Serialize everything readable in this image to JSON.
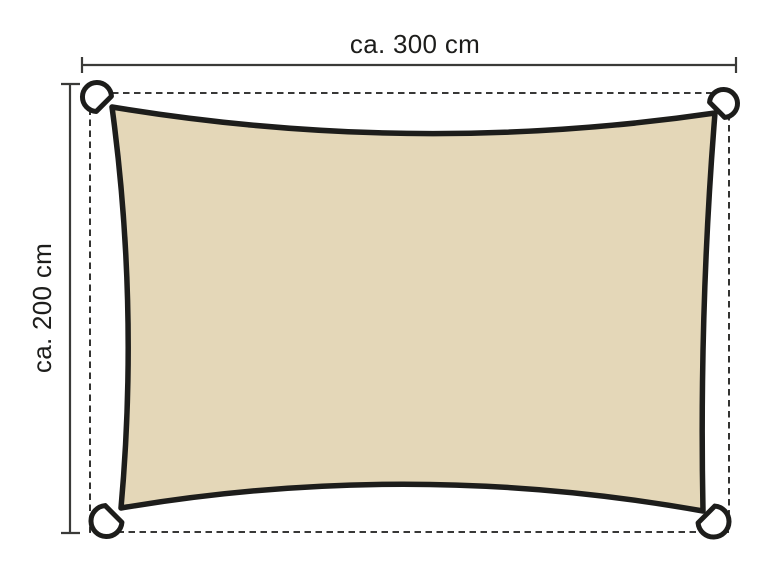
{
  "diagram": {
    "width_label": "ca. 300 cm",
    "height_label": "ca. 200 cm"
  },
  "colors": {
    "background": "#ffffff",
    "sail_fill": "#e4d7b8",
    "sail_outline": "#1d1d1b",
    "ring_fill": "#ffffff",
    "ring_outline": "#1d1d1b",
    "dashed_line": "#1d1d1b",
    "dimension_line": "#3a3a38",
    "label_text": "#1d1d1b"
  }
}
